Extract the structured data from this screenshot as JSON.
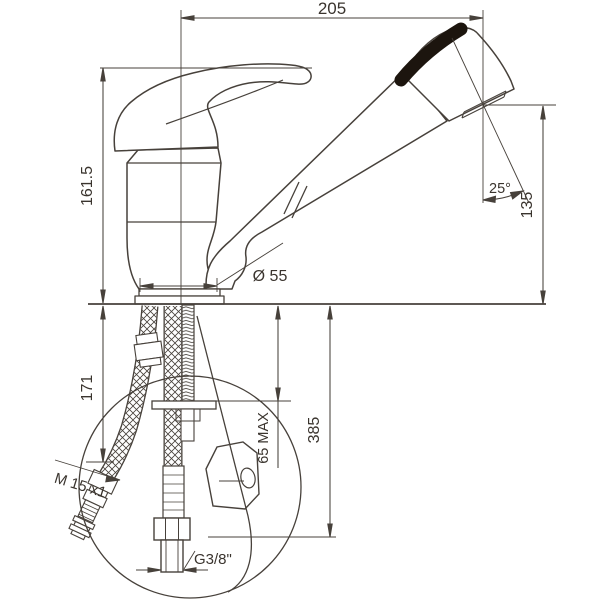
{
  "drawing": {
    "type": "technical-dimension-drawing",
    "subject": "pull-out kitchen faucet installation drawing",
    "colors": {
      "line": "#47413b",
      "text": "#3a342e",
      "grip": "#1c150e",
      "background": "#ffffff"
    },
    "dimensions": {
      "spout_reach": "205",
      "height_above_counter": "161.5",
      "under_counter_depth": "171",
      "spray_outlet_height": "135",
      "spray_angle": "25°",
      "base_diameter": "Ø 55",
      "counter_thickness_max": "65 MAX",
      "hose_drop": "385",
      "supply_fitting_thread": "M 15 x1",
      "connection_thread": "G3/8\""
    }
  }
}
